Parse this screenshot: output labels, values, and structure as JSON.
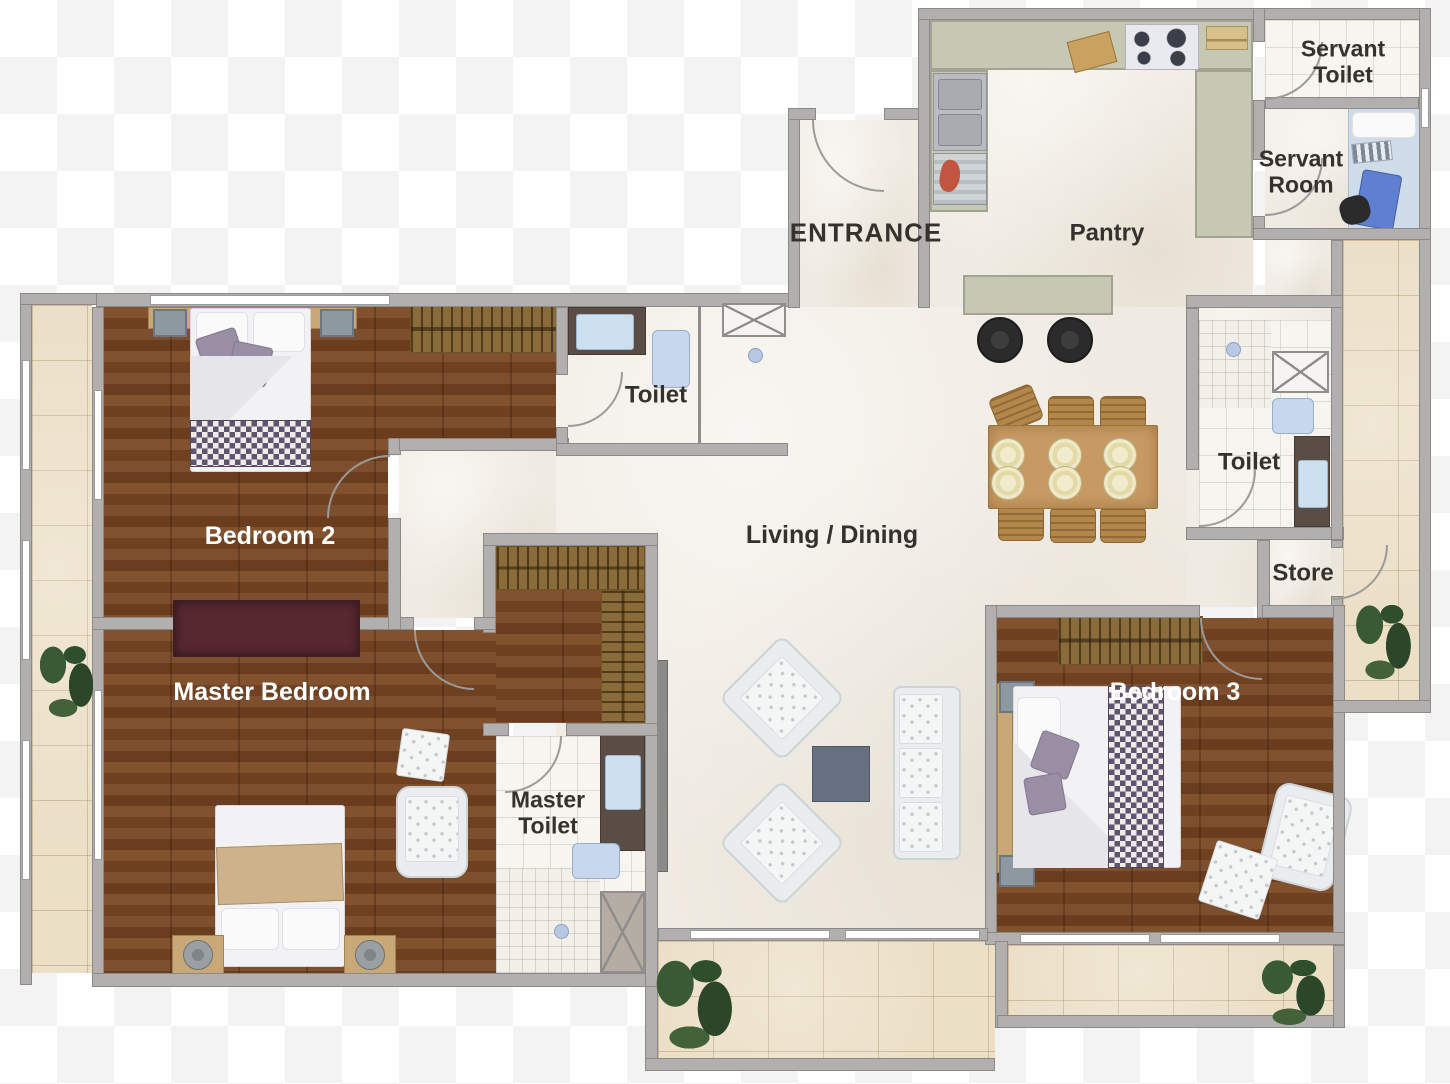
{
  "title": "Apartment Floor Plan",
  "rooms": {
    "entrance": {
      "label": "ENTRANCE"
    },
    "pantry": {
      "label": "Pantry"
    },
    "servant_toilet": {
      "label": "Servant Toilet"
    },
    "servant_room": {
      "label": "Servant Room"
    },
    "toilet_top": {
      "label": "Toilet"
    },
    "toilet_right": {
      "label": "Toilet"
    },
    "store": {
      "label": "Store"
    },
    "living_dining": {
      "label": "Living / Dining"
    },
    "bedroom2": {
      "label": "Bedroom 2"
    },
    "bedroom3": {
      "label": "Bedroom 3"
    },
    "master_bedroom": {
      "label": "Master Bedroom"
    },
    "master_toilet": {
      "label": "Master Toilet"
    }
  },
  "palette": {
    "wall": "#b1b0ae",
    "wall_edge": "#8b8a88",
    "wood_floor": "#7a4a26",
    "marble_floor": "#f0ebe2",
    "bath_tile": "#f7f5ef",
    "balcony_tile": "#ebdfc6",
    "kitchen_counter": "#c7c8b4",
    "label_dark": "#35322e",
    "label_light": "#ffffff",
    "blanket_checker": "#5f5570",
    "plant_green": "#335231"
  }
}
